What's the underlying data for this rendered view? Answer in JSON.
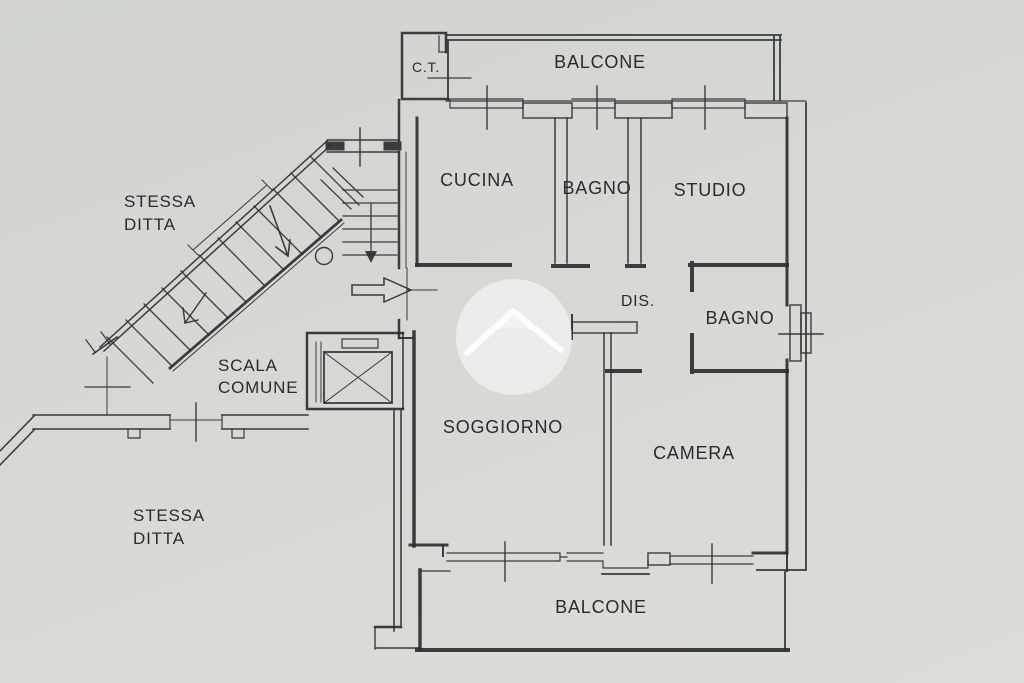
{
  "document": {
    "type": "apartment-floor-plan"
  },
  "colors": {
    "paper": "#d6d8d3",
    "ink": "#2c2f31",
    "text": "#292c2e",
    "watermark": "#ffffff"
  },
  "rooms": {
    "balcone_top": "BALCONE",
    "ct": "C.T.",
    "cucina": "CUCINA",
    "bagno_1": "BAGNO",
    "studio": "STUDIO",
    "dis": "DIS.",
    "bagno_2": "BAGNO",
    "soggiorno": "SOGGIORNO",
    "camera": "CAMERA",
    "balcone_bottom": "BALCONE"
  },
  "common_areas": {
    "scala_line1": "SCALA",
    "scala_line2": "COMUNE",
    "stessa_top_line1": "STESSA",
    "stessa_top_line2": "DITTA",
    "stessa_bottom_line1": "STESSA",
    "stessa_bottom_line2": "DITTA"
  },
  "icons": {
    "watermark": "house-roof-watermark",
    "entry_arrow": "entry-direction-arrow",
    "stair_arrows": "stair-direction-arrows",
    "elevator": "elevator-x-symbol",
    "window_ticks": "window-center-ticks"
  }
}
